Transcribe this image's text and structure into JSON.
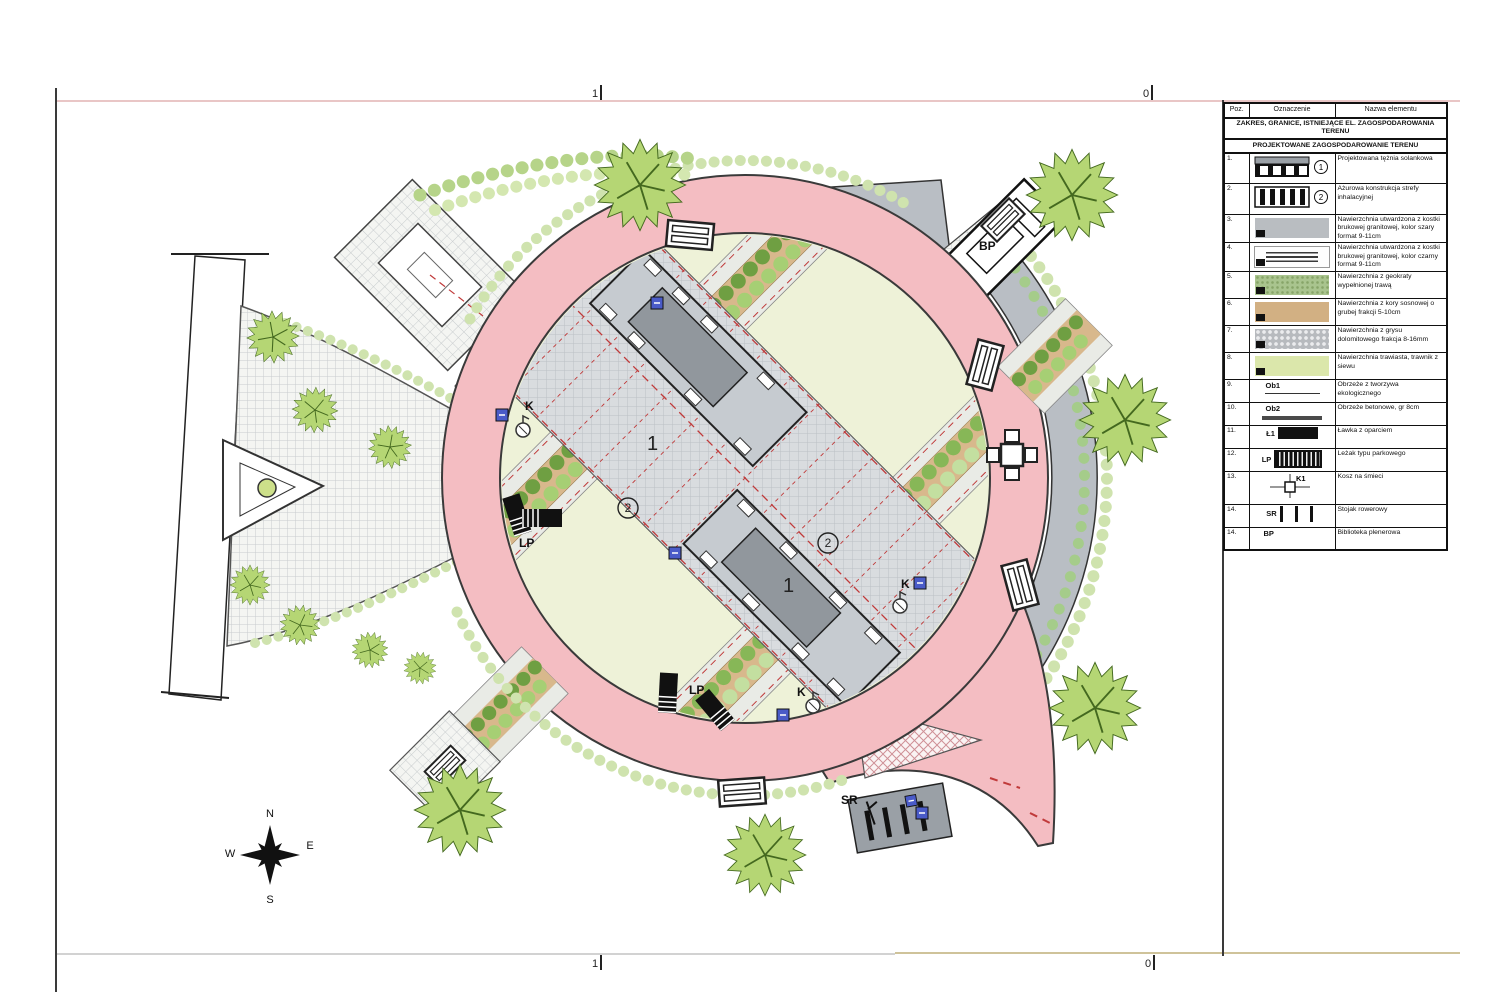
{
  "page": {
    "ruler": {
      "one": "1",
      "zero": "0"
    }
  },
  "plan": {
    "labels": {
      "n1": "1",
      "n2": "2",
      "k": "K",
      "lp": "LP",
      "sr": "SR",
      "bp": "BP"
    },
    "compass": {
      "n": "N",
      "e": "E",
      "s": "S",
      "w": "W"
    },
    "colors": {
      "path_pink": "#f4bdc2",
      "paving_gray": "#d7dadd",
      "area_gray": "#b9bec4",
      "structure_dark": "#91979d",
      "bark_tan": "#d8b88c",
      "grass": "#eef2d8",
      "tree_green": "#b5d674",
      "tree_outline": "#44691f",
      "hedge": "#cfe3ae",
      "red_dash": "#c03a3a",
      "marker_blue": "#4a5bc8"
    }
  },
  "legend": {
    "columns": [
      "Poz.",
      "Oznaczenie",
      "Nazwa elementu"
    ],
    "section1": "ZAKRES, GRANICE, ISTNIEJĄCE EL. ZAGOSPODAROWANIA TERENU",
    "section2": "PROJEKTOWANE ZAGOSPODAROWANIE TERENU",
    "rows": [
      {
        "poz": "1.",
        "mark": "1",
        "label": "",
        "name": "Projektowana tężnia solankowa"
      },
      {
        "poz": "2.",
        "mark": "2",
        "label": "",
        "name": "Ażurowa konstrukcja strefy inhalacyjnej"
      },
      {
        "poz": "3.",
        "label": "",
        "name": "Nawierzchnia utwardzona z kostki brukowej granitowej, kolor szary format 9-11cm"
      },
      {
        "poz": "4.",
        "label": "",
        "name": "Nawierzchnia utwardzona z kostki brukowej granitowej, kolor czarny format 9-11cm"
      },
      {
        "poz": "5.",
        "label": "",
        "name": "Nawierzchnia z geokraty wypełnionej trawą"
      },
      {
        "poz": "6.",
        "label": "",
        "name": "Nawierzchnia z kory sosnowej o grubej frakcji 5-10cm"
      },
      {
        "poz": "7.",
        "label": "",
        "name": "Nawierzchnia z grysu dolomitowego frakcja 8-16mm"
      },
      {
        "poz": "8.",
        "label": "",
        "name": "Nawierzchnia trawiasta, trawnik z siewu"
      },
      {
        "poz": "9.",
        "label": "Ob1",
        "name": "Obrzeże z tworzywa ekologicznego"
      },
      {
        "poz": "10.",
        "label": "Ob2",
        "name": "Obrzeże betonowe, gr 8cm"
      },
      {
        "poz": "11.",
        "label": "Ł1",
        "name": "Ławka z oparciem"
      },
      {
        "poz": "12.",
        "label": "LP",
        "name": "Leżak typu parkowego"
      },
      {
        "poz": "13.",
        "label": "K1",
        "name": "Kosz na śmieci"
      },
      {
        "poz": "14.",
        "label": "SR",
        "name": "Stojak rowerowy"
      },
      {
        "poz": "14.",
        "label": "BP",
        "name": "Biblioteka plenerowa"
      }
    ]
  }
}
